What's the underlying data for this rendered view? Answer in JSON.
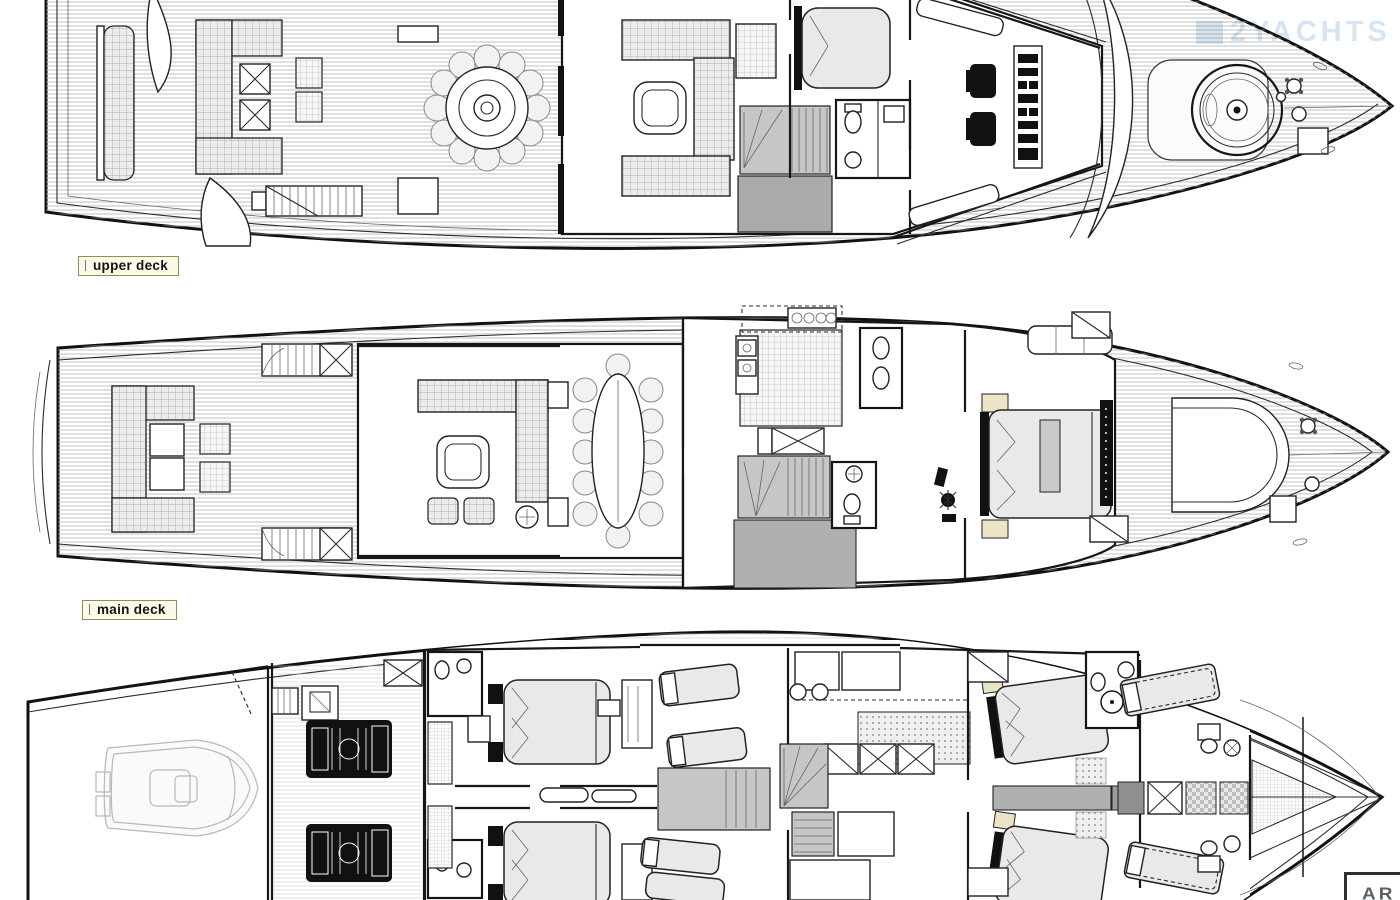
{
  "page": {
    "background": "#ffffff"
  },
  "plans": {
    "upper_deck": {
      "label": "upper deck"
    },
    "main_deck": {
      "label": "main deck"
    }
  },
  "label_style": {
    "background": "#fcfae6",
    "border_color": "#8f8f5a",
    "text_color": "#141414"
  },
  "watermark": {
    "text": "2YACHTS",
    "color": "#9cc0dd"
  },
  "brand_logo": {
    "text": "AR",
    "border_color": "#2e2e2e",
    "text_color": "#596066"
  },
  "drawing_colors": {
    "ink": "#161616",
    "plank_line": "#a8a8a8",
    "stair_fill": "#c6c6c6",
    "corridor_fill": "#b0b0b0",
    "cushion_fill": "#ececec",
    "mattress_fill": "#e9e9e9",
    "engine_fill": "#111111",
    "tender_line": "#b8b8b8",
    "nightstand_fill": "#ece4c6"
  }
}
